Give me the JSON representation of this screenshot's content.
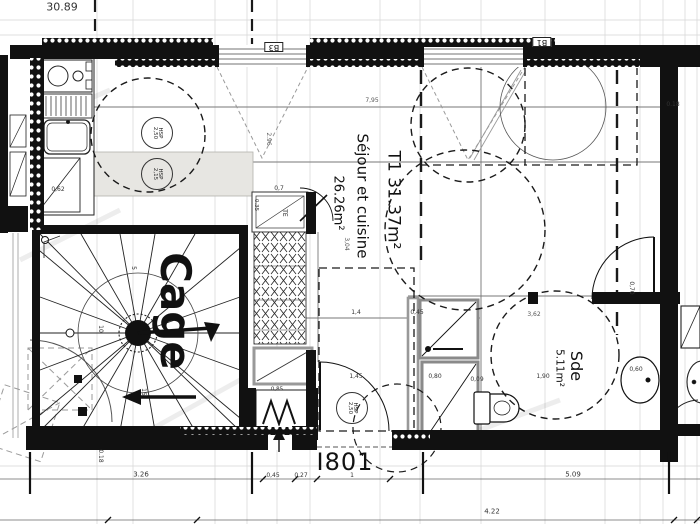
{
  "labels": {
    "apartment_type": "T1 31.37m²",
    "main_room": "Séjour et cuisine",
    "main_room_area": "26.26m²",
    "stairwell": "Cage",
    "bathroom": "Sde",
    "bathroom_area": "5.11m²",
    "unit_number": "I801",
    "window_b3": "B3",
    "window_b1": "B1",
    "electrical_panel": "TE"
  },
  "hsp_markers": {
    "kitchen_upper": {
      "line1": "HSP",
      "line2": "2,50"
    },
    "kitchen_lower": {
      "line1": "HSP",
      "line2": "2,15"
    },
    "entry": {
      "line1": "HSP",
      "line2": "2,50"
    }
  },
  "stair_step_numbers": {
    "a": "5",
    "b": "10",
    "c": "15"
  },
  "dimensions": {
    "top_width": "30.89",
    "room_width": "7,95",
    "d_296": "2.96",
    "d_304": "3,04",
    "d_07": "0,7",
    "d_14": "1,4",
    "d_045_sde": "0,45",
    "d_145": "1,45",
    "d_080": "0,80",
    "d_009": "0,09",
    "d_190": "1,90",
    "d_060": "0,60",
    "d_362": "3,62",
    "d_070": "0,70",
    "d_018_right": "0.18",
    "d_018_bottom": "0.18",
    "d_326": "3.26",
    "d_045_door": "0,45",
    "d_027": "0,27",
    "d_1": "1",
    "d_509": "5.09",
    "d_422": "4.22",
    "d_062": "0,62",
    "d_035": "0.35",
    "d_085": "0,85"
  },
  "colors": {
    "wall": "#111111",
    "line": "#333333",
    "grid": "#cccccc",
    "opening_gray": "#9a9a9a",
    "counter_fill": "#e7e6e2",
    "paper": "#ffffff"
  }
}
